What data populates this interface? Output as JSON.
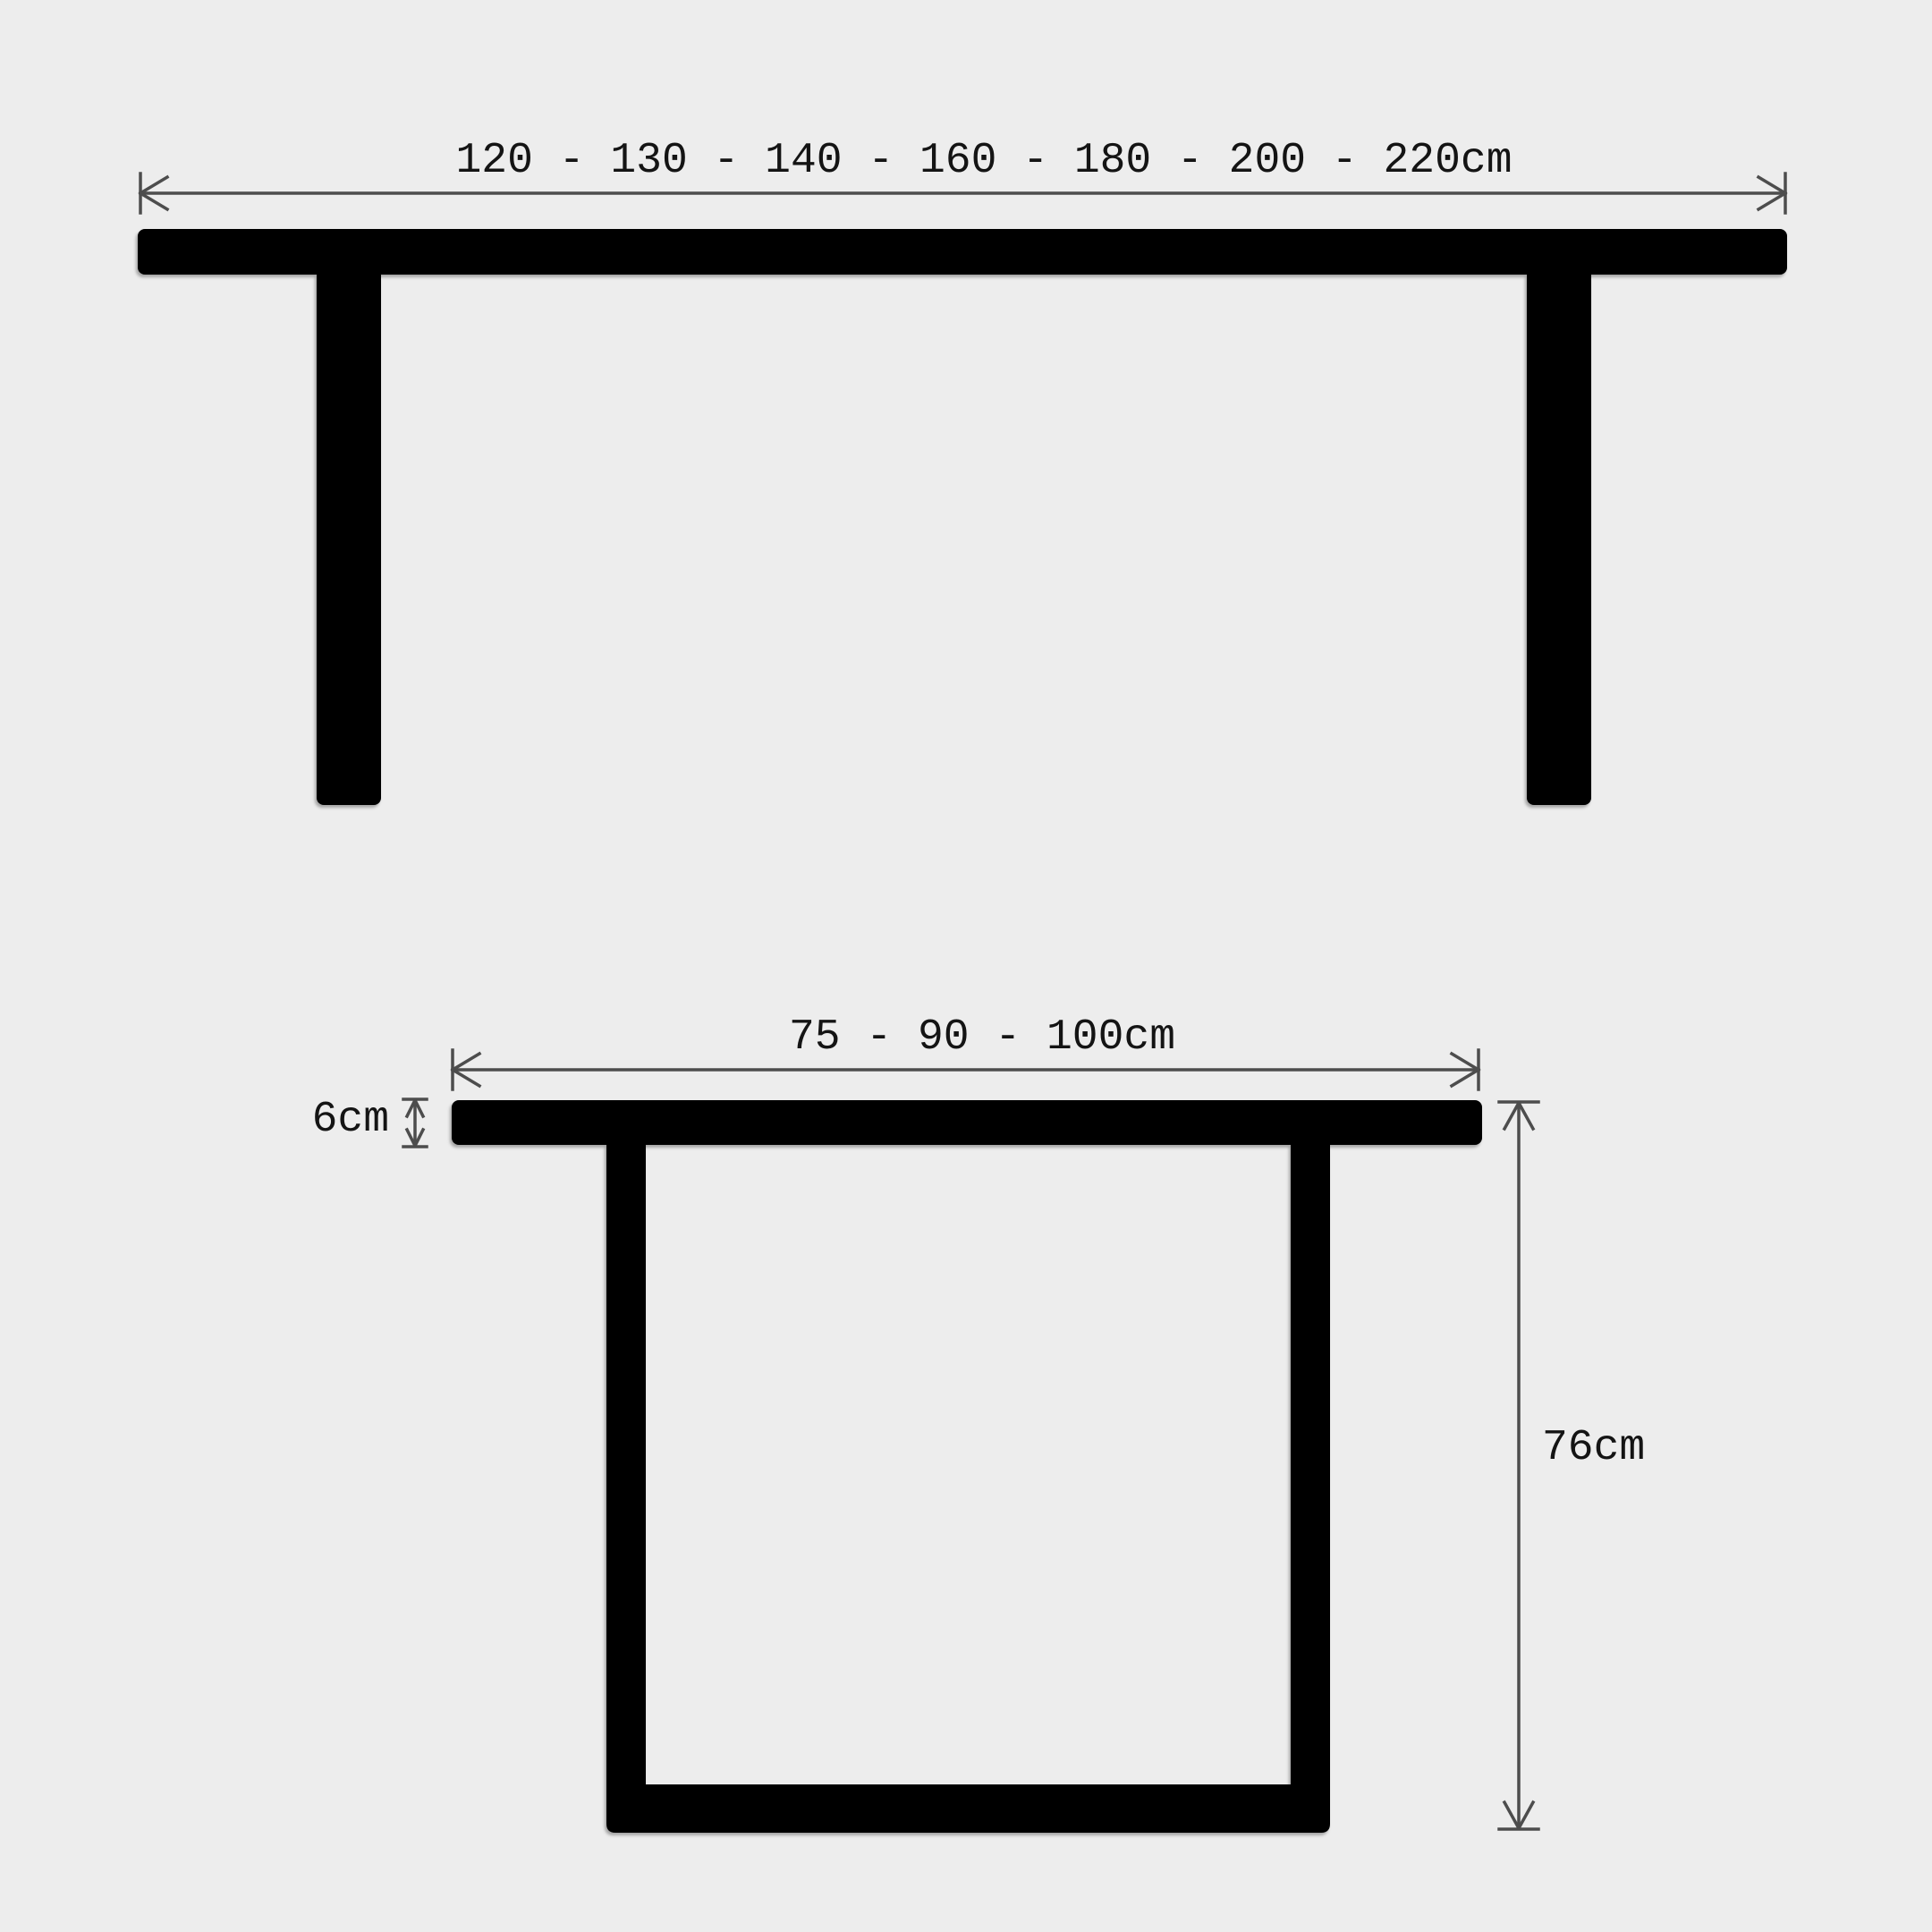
{
  "diagram": {
    "type": "furniture-dimension-drawing",
    "views": {
      "front": {
        "width_label": "120 - 130 - 140 - 160 - 180 - 200 - 220cm"
      },
      "side": {
        "depth_label": "75 - 90 - 100cm",
        "top_thickness_label": "6cm",
        "height_label": "76cm"
      }
    },
    "colors": {
      "background": "#ededed",
      "shape": "#000000",
      "dimension_line": "#4d4d4d",
      "text": "#141414"
    }
  }
}
